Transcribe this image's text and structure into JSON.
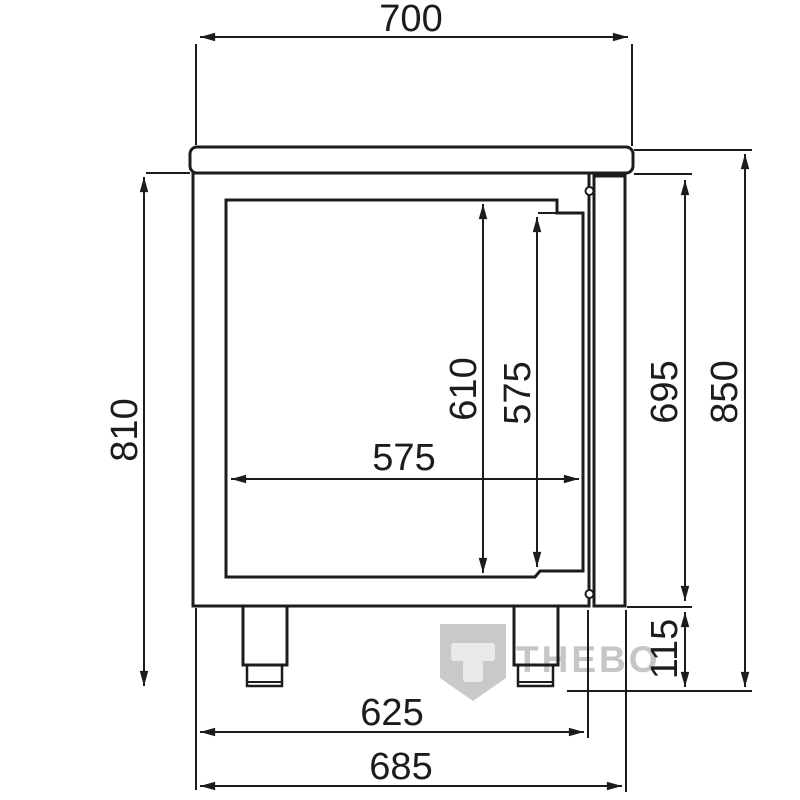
{
  "dimensions": {
    "top_width": "700",
    "overall_left_height": "810",
    "inner_cavity_height": "610",
    "door_opening_height": "575",
    "inner_cavity_width": "575",
    "body_with_door_height": "695",
    "overall_height": "850",
    "leg_height": "115",
    "base_width": "625",
    "overall_depth": "685"
  },
  "watermark": {
    "brand_text": "THEBO",
    "logo_letter": "T"
  },
  "colors": {
    "line": "#1c1c1c",
    "background": "#ffffff",
    "watermark_shield": "#c9c9c9",
    "watermark_letter": "#e9e9e9",
    "watermark_text": "#c6c6c6"
  }
}
